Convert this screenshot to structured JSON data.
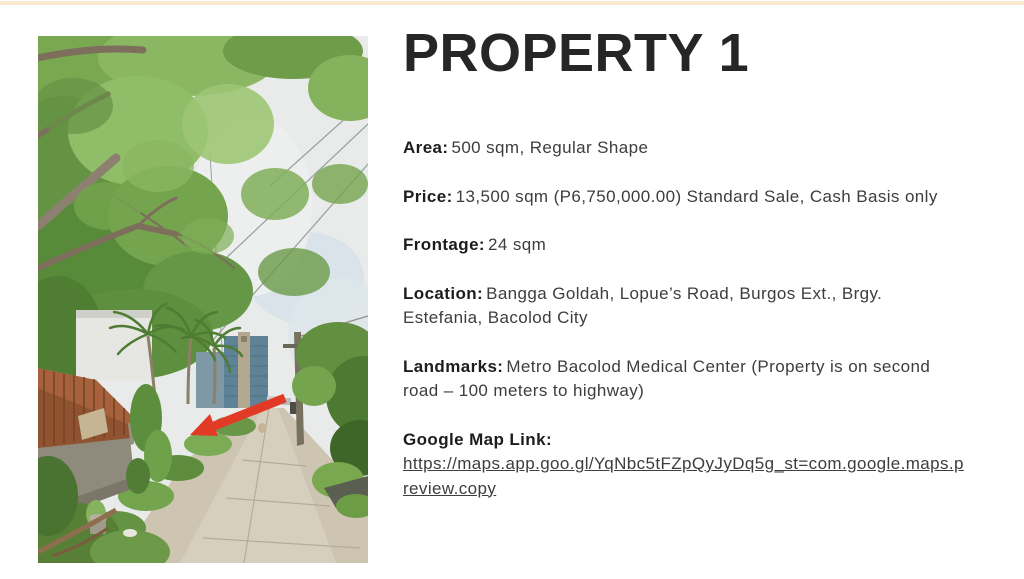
{
  "page": {
    "background_color": "#ffffff",
    "accent_bar_color": "#fcead0"
  },
  "photo": {
    "name": "street-view-photo",
    "arrow_color": "#e23b25"
  },
  "content": {
    "title": "PROPERTY 1",
    "title_color": "#262626",
    "body_color": "#3d3d3d",
    "fields": [
      {
        "label": "Area:",
        "value": "500 sqm, Regular Shape"
      },
      {
        "label": "Price:",
        "value": "13,500 sqm (P6,750,000.00) Standard Sale, Cash Basis only"
      },
      {
        "label": "Frontage:",
        "value": "24 sqm"
      },
      {
        "label": "Location:",
        "value": "Bangga Goldah, Lopue’s Road, Burgos Ext., Brgy. Estefania, Bacolod City"
      },
      {
        "label": "Landmarks:",
        "value": "Metro Bacolod Medical Center (Property is on second road – 100 meters to highway)"
      },
      {
        "label": "Google Map Link:",
        "link": "https://maps.app.goo.gl/YqNbc5tFZpQyJyDq5g_st=com.google.maps.preview.copy"
      }
    ]
  }
}
